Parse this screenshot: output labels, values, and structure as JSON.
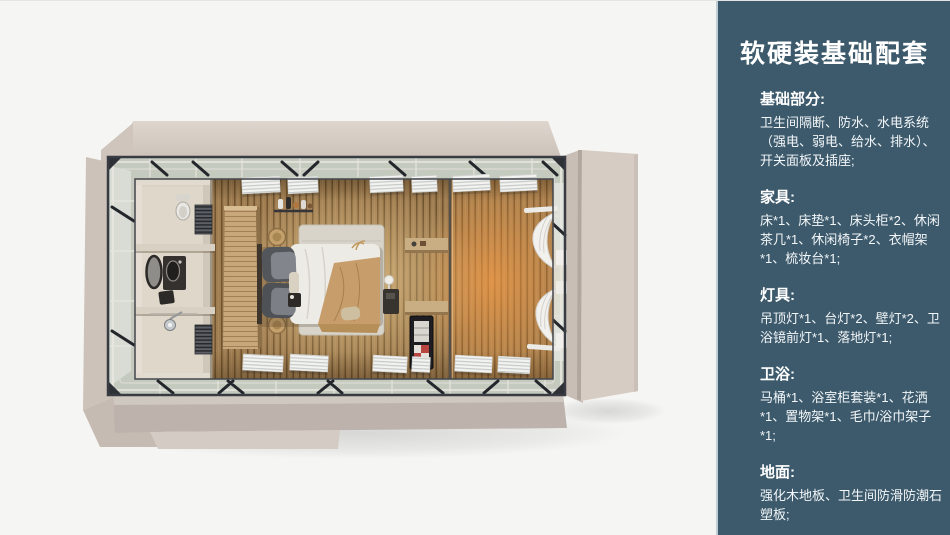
{
  "page": {
    "background": "#f5f5f3"
  },
  "sidebar": {
    "title": "软硬装基础配套",
    "background": "#3d5a6c",
    "border_color": "#bfcdd5",
    "text_color": "#ffffff",
    "sections": [
      {
        "heading": "基础部分:",
        "body": "卫生间隔断、防水、水电系统（强电、弱电、给水、排水）、开关面板及插座;"
      },
      {
        "heading": "家具:",
        "body": "床*1、床垫*1、床头柜*2、休闲茶几*1、休闲椅子*2、衣帽架*1、梳妆台*1;"
      },
      {
        "heading": "灯具:",
        "body": "吊顶灯*1、台灯*2、壁灯*2、卫浴镜前灯*1、落地灯*1;"
      },
      {
        "heading": "卫浴:",
        "body": "马桶*1、浴室柜套装*1、花洒*1、置物架*1、毛巾/浴巾架子*1;"
      },
      {
        "heading": "地面:",
        "body": "强化木地板、卫生间防滑防潮石塑板;"
      }
    ]
  },
  "scene": {
    "description": "鸟瞰三维渲染：预制模块客房（卫生间、衣柜隔断、双人床、置物架、迷你吧、窗帘）",
    "colors": {
      "exterior_wall": "#d5cbc2",
      "steel_frame": "#383c42",
      "wood_floor": "#a07d50",
      "warm_glow": "#ffb269",
      "bathroom_pod": "#d9d2c5",
      "wardrobe": "#c8a87a",
      "duvet": "#edebe6",
      "throw_blanket": "#c79e6b",
      "rug": "#d9d4ca",
      "curtain": "#f2f1ee"
    },
    "furniture": [
      "bathroom-pod",
      "toilet",
      "vanity-set",
      "shower-head",
      "towel-radiator",
      "wardrobe-partition",
      "coat-rack-shelf",
      "bedside-basket",
      "double-bed",
      "pillows",
      "rug",
      "table-lamp",
      "wall-shelf",
      "minibar-cabinet",
      "curtains",
      "louver-windows"
    ]
  }
}
